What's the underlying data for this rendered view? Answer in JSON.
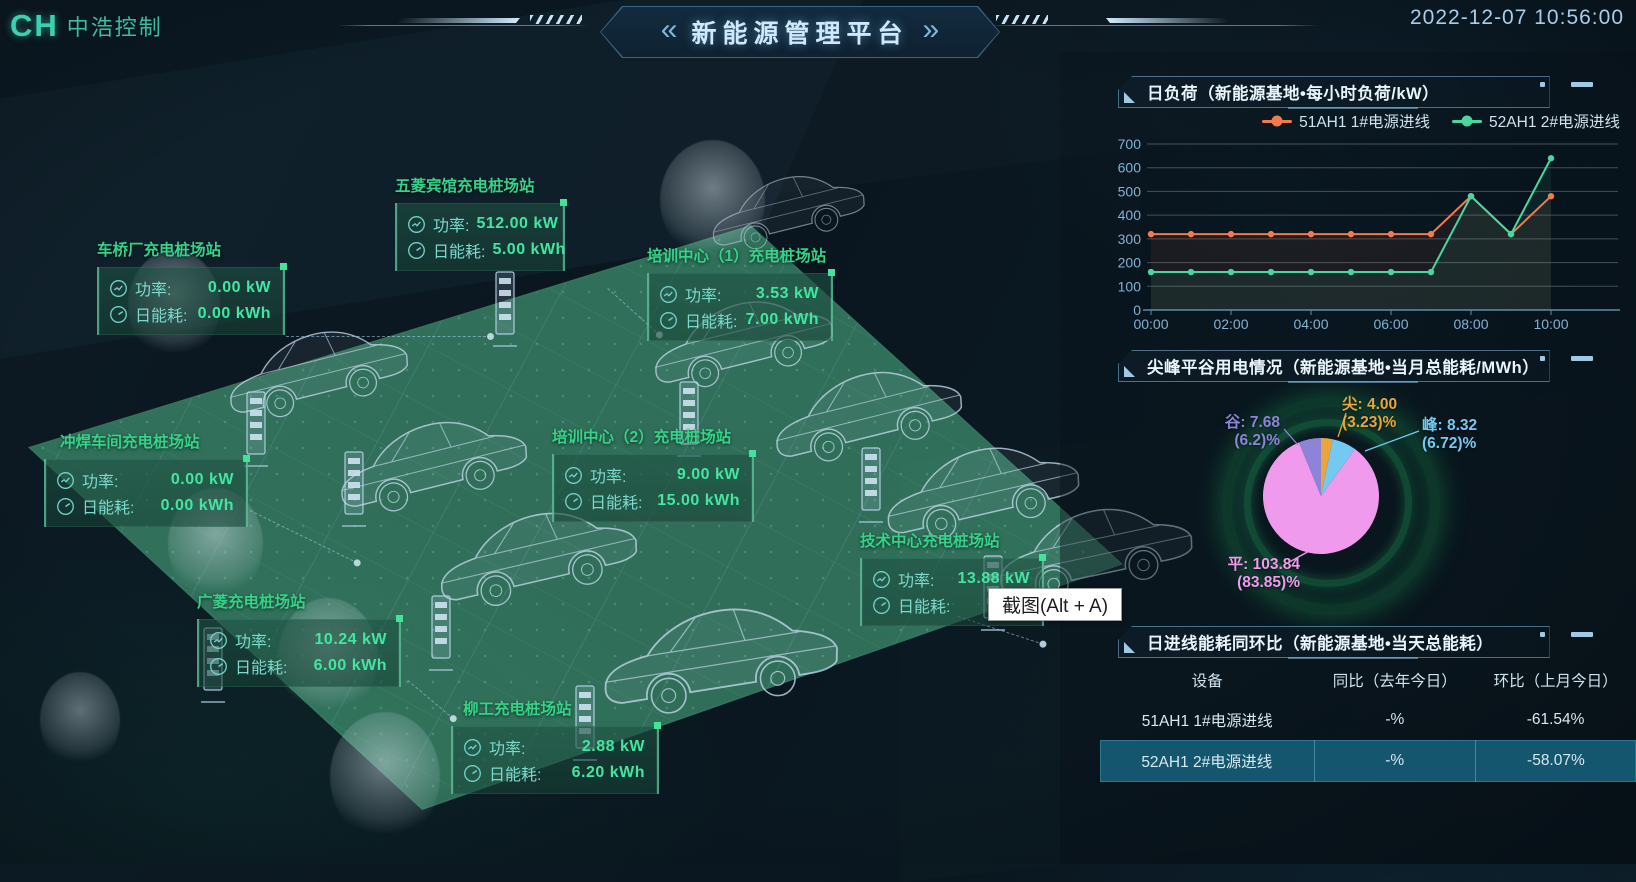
{
  "header": {
    "logo_mark": "CH",
    "logo_text": "中浩控制",
    "title": "新能源管理平台",
    "timestamp": "2022-12-07 10:56:00"
  },
  "labels": {
    "power": "功率:",
    "energy": "日能耗:"
  },
  "tooltip": {
    "text": "截图(Alt + A)"
  },
  "stations": [
    {
      "name": "五菱宾馆充电桩场站",
      "power": "512.00 kW",
      "energy": "5.00 kWh"
    },
    {
      "name": "车桥厂充电桩场站",
      "power": "0.00 kW",
      "energy": "0.00 kWh"
    },
    {
      "name": "培训中心（1）充电桩场站",
      "power": "3.53 kW",
      "energy": "7.00 kWh"
    },
    {
      "name": "冲焊车间充电桩场站",
      "power": "0.00 kW",
      "energy": "0.00 kWh"
    },
    {
      "name": "培训中心（2）充电桩场站",
      "power": "9.00 kW",
      "energy": "15.00 kWh"
    },
    {
      "name": "技术中心充电桩场站",
      "power": "13.88 kW",
      "energy": ""
    },
    {
      "name": "广菱充电桩场站",
      "power": "10.24 kW",
      "energy": "6.00 kWh"
    },
    {
      "name": "柳工充电桩场站",
      "power": "2.88 kW",
      "energy": "6.20 kWh"
    }
  ],
  "panels": {
    "load": {
      "title": "日负荷（新能源基地•每小时负荷/kW）"
    },
    "pie": {
      "title": "尖峰平谷用电情况（新能源基地•当月总能耗/MWh）"
    },
    "table": {
      "title": "日进线能耗同环比（新能源基地•当天总能耗）",
      "headers": [
        "设备",
        "同比（去年今日）",
        "环比（上月今日）"
      ],
      "rows": [
        {
          "device": "51AH1 1#电源进线",
          "yoy": "-%",
          "mom": "-61.54%"
        },
        {
          "device": "52AH1 2#电源进线",
          "yoy": "-%",
          "mom": "-58.07%"
        }
      ]
    }
  },
  "chart_data": [
    {
      "type": "line",
      "title": "日负荷（新能源基地•每小时负荷/kW）",
      "xlabel": "",
      "ylabel": "每小时负荷/kW",
      "x": [
        "00:00",
        "01:00",
        "02:00",
        "03:00",
        "04:00",
        "05:00",
        "06:00",
        "07:00",
        "08:00",
        "09:00",
        "10:00"
      ],
      "x_tick_labels": [
        "00:00",
        "02:00",
        "04:00",
        "06:00",
        "08:00",
        "10:00"
      ],
      "ylim": [
        0,
        700
      ],
      "yticks": [
        0,
        100,
        200,
        300,
        400,
        500,
        600,
        700
      ],
      "grid": true,
      "legend_position": "top-right",
      "series": [
        {
          "name": "51AH1 1#电源进线",
          "color": "#f4794b",
          "values": [
            320,
            320,
            320,
            320,
            320,
            320,
            320,
            320,
            480,
            320,
            480
          ]
        },
        {
          "name": "52AH1 2#电源进线",
          "color": "#49d6a0",
          "values": [
            160,
            160,
            160,
            160,
            160,
            160,
            160,
            160,
            480,
            320,
            640
          ]
        }
      ]
    },
    {
      "type": "pie",
      "title": "尖峰平谷用电情况（新能源基地•当月总能耗/MWh）",
      "unit": "MWh",
      "slices": [
        {
          "name": "尖",
          "value": 4.0,
          "pct": 3.23,
          "color": "#eaa63c",
          "label1": "尖: 4.00",
          "label2": "(3.23)%"
        },
        {
          "name": "峰",
          "value": 8.32,
          "pct": 6.72,
          "color": "#74c9f2",
          "label1": "峰: 8.32",
          "label2": "(6.72)%"
        },
        {
          "name": "平",
          "value": 103.84,
          "pct": 83.85,
          "color": "#ef9aec",
          "label1": "平: 103.84",
          "label2": "(83.85)%"
        },
        {
          "name": "谷",
          "value": 7.68,
          "pct": 6.2,
          "color": "#8d84d8",
          "label1": "谷: 7.68",
          "label2": "(6.2)%"
        }
      ]
    },
    {
      "type": "table",
      "title": "日进线能耗同环比（新能源基地•当天总能耗）",
      "columns": [
        "设备",
        "同比（去年今日）",
        "环比（上月今日）"
      ],
      "rows": [
        [
          "51AH1 1#电源进线",
          "-%",
          "-61.54%"
        ],
        [
          "52AH1 2#电源进线",
          "-%",
          "-58.07%"
        ]
      ]
    }
  ]
}
